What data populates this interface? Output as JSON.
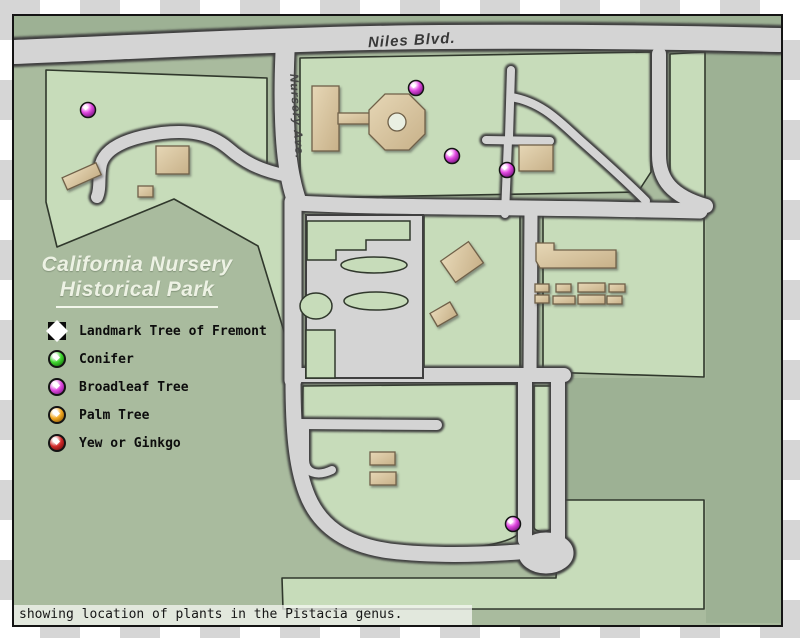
{
  "map": {
    "title": {
      "line1": "California Nursery",
      "line2": "Historical Park"
    },
    "road_labels": {
      "niles": "Niles Blvd.",
      "nursery": "Nursery Ave."
    },
    "legend": {
      "items": [
        {
          "id": "landmark-tree-of-fremont",
          "label": "Landmark Tree of Fremont",
          "marker": "diamond",
          "color": "#ffffff",
          "shade": "#111111"
        },
        {
          "id": "conifer",
          "label": "Conifer",
          "marker": "ball",
          "color": "#3fd62e",
          "shade": "#0e5c0a"
        },
        {
          "id": "broadleaf-tree",
          "label": "Broadleaf Tree",
          "marker": "ball",
          "color": "#e049e0",
          "shade": "#6d1076"
        },
        {
          "id": "palm-tree",
          "label": "Palm Tree",
          "marker": "ball",
          "color": "#f2a821",
          "shade": "#7a4d05"
        },
        {
          "id": "yew-or-ginkgo",
          "label": "Yew or Ginkgo",
          "marker": "ball",
          "color": "#d32a2a",
          "shade": "#5d0808"
        }
      ]
    },
    "caption": "showing location of plants in the Pistacia genus.",
    "plant_markers": {
      "genus": "Pistacia",
      "category": "Broadleaf Tree",
      "color": "#e049e0",
      "shade": "#6d1076",
      "points": [
        {
          "x": 88,
          "y": 110
        },
        {
          "x": 416,
          "y": 88
        },
        {
          "x": 452,
          "y": 156
        },
        {
          "x": 507,
          "y": 170
        },
        {
          "x": 513,
          "y": 524
        }
      ]
    },
    "colors": {
      "park_green": "#c7dcba",
      "background_green": "#a9bb9e",
      "outer_green": "#9db194",
      "road_gray": "#d4d4d4",
      "building_tan": "#d9c5a0"
    }
  }
}
